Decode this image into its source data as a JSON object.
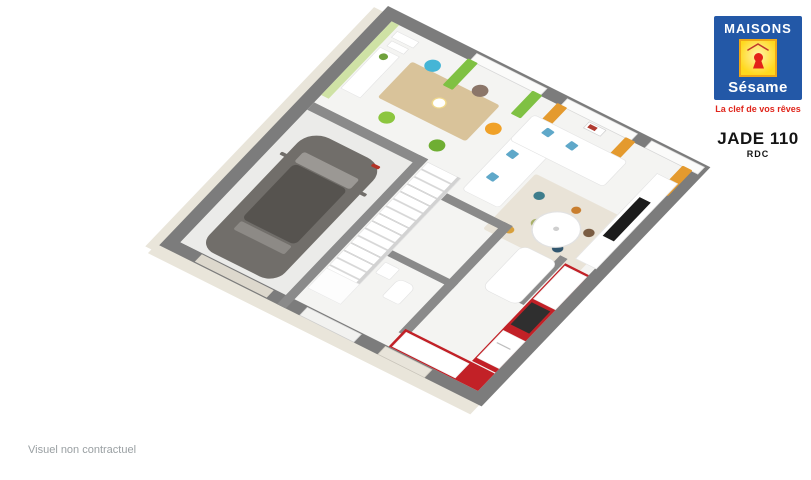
{
  "branding": {
    "name_top": "MAISONS",
    "name_bottom": "Sésame",
    "tagline": "La clef de vos rêves",
    "colors": {
      "blue": "#2358a7",
      "yellow": "#ffd91e",
      "red": "#e32119",
      "tagline_red": "#e0261c"
    }
  },
  "plan_header": {
    "title": "JADE 110",
    "subtitle": "RDC"
  },
  "footer": {
    "disclaimer": "Visuel non contractuel"
  },
  "floorplan": {
    "view": "3d-axonometric-ground-floor",
    "rooms": [
      {
        "name": "dining-area"
      },
      {
        "name": "living-room"
      },
      {
        "name": "kitchen"
      },
      {
        "name": "garage"
      },
      {
        "name": "staircase"
      },
      {
        "name": "hallway"
      },
      {
        "name": "wc"
      }
    ],
    "colors": {
      "wall_top": "#7c7c7c",
      "interior_wall": "#8a8a8a",
      "floor": "#f4f4f2",
      "accent_wall_green": "#cfe2a5",
      "curtain_green": "#7fc143",
      "curtain_orange": "#e49a2e",
      "kitchen_red": "#c22127",
      "car_gray": "#716e6a",
      "facade_cream": "#e9e5da",
      "table_wood": "#d9c39a",
      "chair_blue": "#45b5d6",
      "chair_orange": "#f0a128",
      "chair_green": "#8cc63f",
      "chair_brown": "#8b7669"
    }
  }
}
